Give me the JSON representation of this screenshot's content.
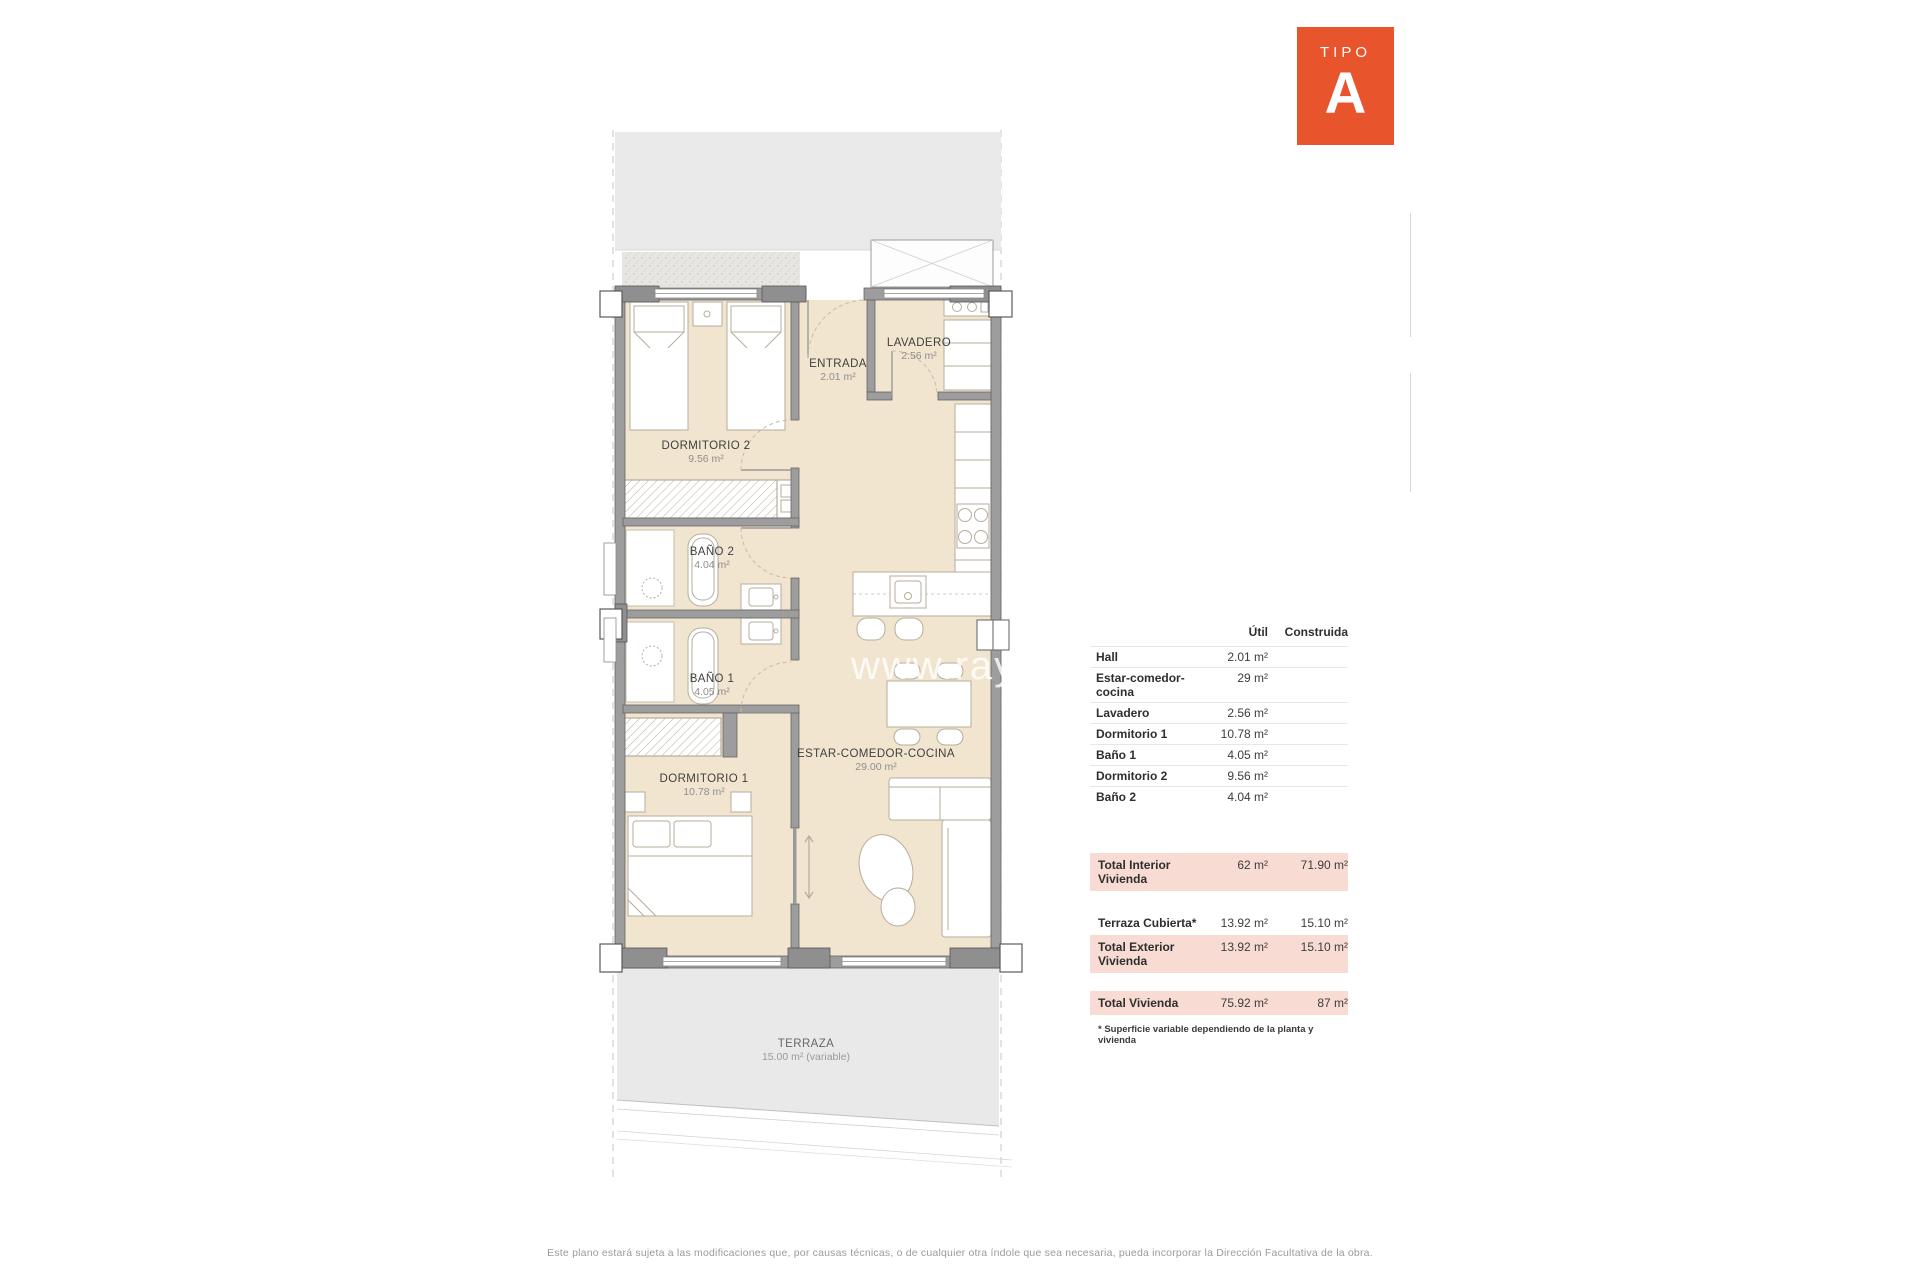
{
  "badge": {
    "label": "TIPO",
    "letter": "A",
    "color": "#e8542c"
  },
  "plan": {
    "watermark": "www.rayosdes",
    "rooms": {
      "dormitorio2": {
        "name": "DORMITORIO 2",
        "area": "9.56 m²"
      },
      "entrada": {
        "name": "ENTRADA",
        "area": "2.01 m²"
      },
      "lavadero": {
        "name": "LAVADERO",
        "area": "2.56 m²"
      },
      "bano2": {
        "name": "BAÑO 2",
        "area": "4.04 m²"
      },
      "bano1": {
        "name": "BAÑO 1",
        "area": "4.05 m²"
      },
      "dormitorio1": {
        "name": "DORMITORIO 1",
        "area": "10.78 m²"
      },
      "estar": {
        "name": "ESTAR-COMEDOR-COCINA",
        "area": "29.00 m²"
      },
      "terraza": {
        "name": "TERRAZA",
        "area": "15.00 m² (variable)"
      }
    }
  },
  "table": {
    "headers": {
      "util": "Útil",
      "construida": "Construida"
    },
    "rows": [
      {
        "label": "Hall",
        "util": "2.01 m²"
      },
      {
        "label": "Estar-comedor-cocina",
        "util": "29 m²"
      },
      {
        "label": "Lavadero",
        "util": "2.56 m²"
      },
      {
        "label": "Dormitorio 1",
        "util": "10.78 m²"
      },
      {
        "label": "Baño 1",
        "util": "4.05 m²"
      },
      {
        "label": "Dormitorio 2",
        "util": "9.56 m²"
      },
      {
        "label": "Baño 2",
        "util": "4.04 m²"
      }
    ],
    "totals": {
      "interior": {
        "label": "Total Interior Vivienda",
        "util": "62 m²",
        "construida": "71.90 m²"
      },
      "terraza_cubierta": {
        "label": "Terraza Cubierta*",
        "util": "13.92 m²",
        "construida": "15.10 m²"
      },
      "exterior": {
        "label": "Total Exterior Vivienda",
        "util": "13.92 m²",
        "construida": "15.10 m²"
      },
      "vivienda": {
        "label": "Total Vivienda",
        "util": "75.92 m²",
        "construida": "87 m²"
      }
    },
    "footnote": "* Superficie variable dependiendo de la planta y vivienda",
    "highlight_color": "#f8dcd3"
  },
  "footer": {
    "disclaimer": "Este plano estará sujeta a las modificaciones que, por causas técnicas, o de cualquier otra índole que sea necesaria, pueda incorporar la Dirección Facultativa de la obra."
  }
}
